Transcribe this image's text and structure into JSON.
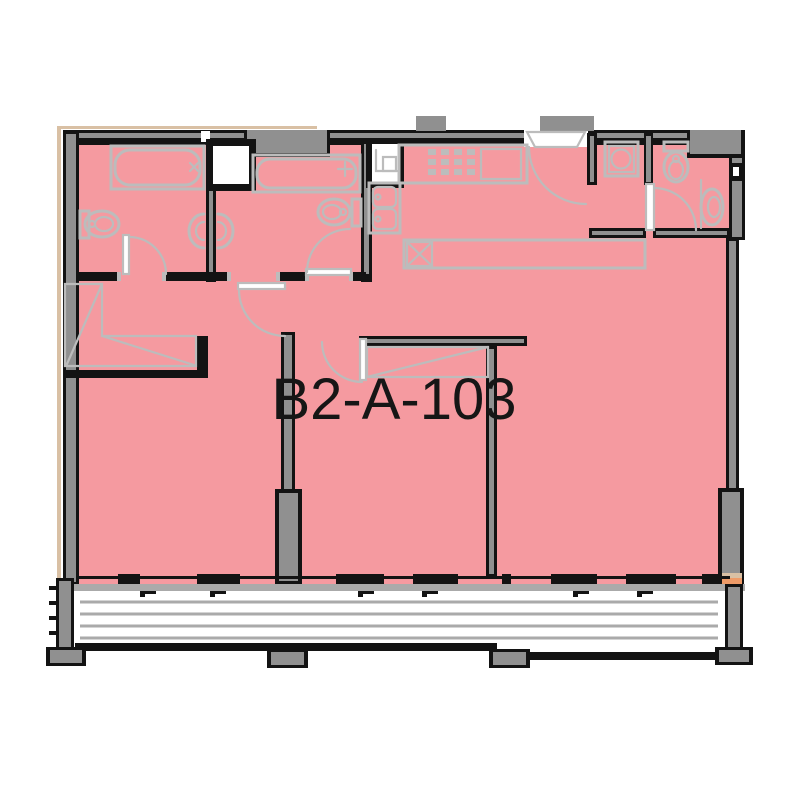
{
  "unit": {
    "label": "B2-A-103"
  },
  "colors": {
    "highlight_pink": "#f59aa0",
    "wall_gray": "#909090",
    "fixture_gray": "#bcbcbc",
    "line_black": "#131313",
    "balcony_gray": "#aaaaaa",
    "accent_tan": "#d9c0a4",
    "accent_orange": "#ee9b68",
    "background": "#ffffff"
  },
  "icons": {
    "fixtures": [
      "bathtub-icon",
      "toilet-icon",
      "sink-icon",
      "stove-icon",
      "kitchen-sink-icon",
      "washer-icon",
      "wardrobe-icon",
      "door-swing-icon",
      "window-icon",
      "balcony-deck-icon",
      "column-icon",
      "shaft-icon"
    ]
  }
}
